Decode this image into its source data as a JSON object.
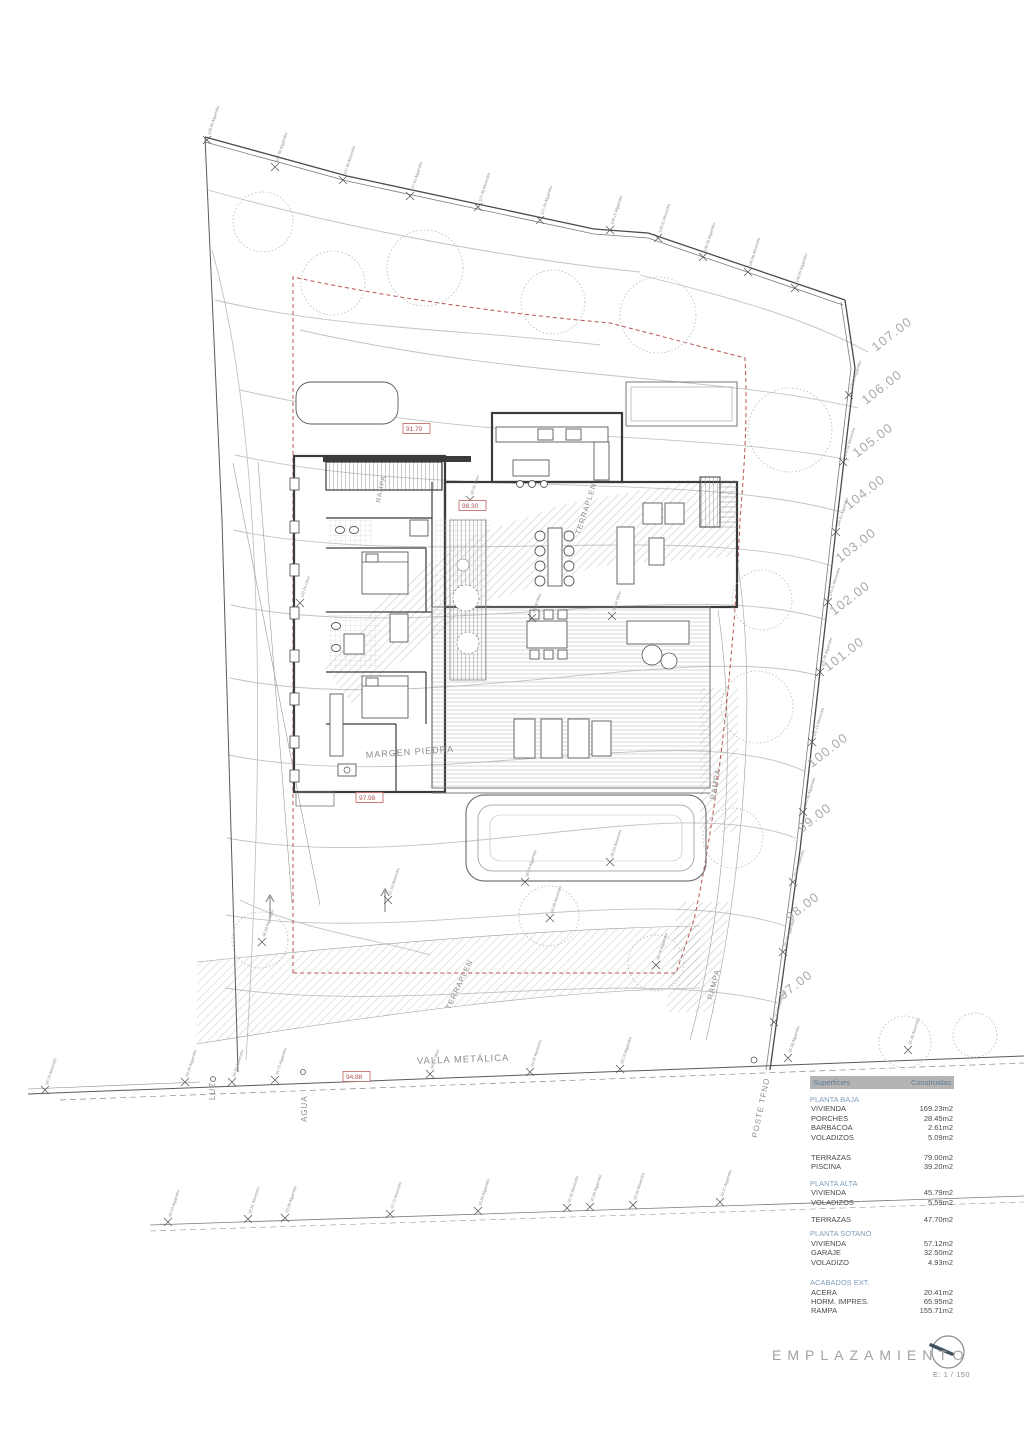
{
  "meta": {
    "sheet_title": "EMPLAZAMIENTO",
    "scale_label": "E: 1 / 150"
  },
  "table": {
    "header": [
      "Superficies",
      "Construidas"
    ],
    "groups": [
      {
        "title": "PLANTA BAJA",
        "gap": 6,
        "rows": [
          [
            "VIVIENDA",
            "169.23m2"
          ],
          [
            "PORCHES",
            "28.45m2"
          ],
          [
            "BARBACOA",
            "2.61m2"
          ],
          [
            "VOLADIZOS",
            "5.09m2"
          ]
        ]
      },
      {
        "title": "",
        "gap": 11,
        "rows": [
          [
            "TERRAZAS",
            "79.00m2"
          ],
          [
            "PISCINA",
            "39.20m2"
          ]
        ]
      },
      {
        "title": "PLANTA ALTA",
        "gap": 7,
        "rows": [
          [
            "VIVIENDA",
            "45.79m2"
          ],
          [
            "VOLADIZOS",
            "5.59m2"
          ]
        ]
      },
      {
        "title": "",
        "gap": 8,
        "rows": [
          [
            "TERRAZAS",
            "47.70m2"
          ]
        ]
      },
      {
        "title": "PLANTA SOTANO",
        "gap": 5,
        "rows": [
          [
            "VIVIENDA",
            "57.12m2"
          ],
          [
            "GARAJE",
            "32.50m2"
          ],
          [
            "VOLADIZO",
            "4.93m2"
          ]
        ]
      },
      {
        "title": "ACABADOS EXT.",
        "gap": 11,
        "rows": [
          [
            "ACERA",
            "20.41m2"
          ],
          [
            "HORM. IMPRES.",
            "65.95m2"
          ],
          [
            "RAMPA",
            "155.71m2"
          ]
        ]
      }
    ]
  },
  "contour_labels": [
    [
      876,
      352,
      "107.00"
    ],
    [
      866,
      405,
      "106.00"
    ],
    [
      857,
      458,
      "105.00"
    ],
    [
      849,
      510,
      "104.00"
    ],
    [
      840,
      563,
      "103.00"
    ],
    [
      834,
      616,
      "102.00"
    ],
    [
      828,
      672,
      "101.00"
    ],
    [
      812,
      768,
      "100.00"
    ],
    [
      802,
      833,
      "99.00"
    ],
    [
      790,
      922,
      "98.00"
    ],
    [
      783,
      1000,
      "97.00"
    ]
  ],
  "red_levels": [
    [
      406,
      431,
      "91.70"
    ],
    [
      462,
      508,
      "98.30"
    ],
    [
      359,
      800,
      "97.98"
    ],
    [
      346,
      1079,
      "94.88"
    ]
  ],
  "annotations": [
    [
      417,
      1064,
      -2,
      9.5,
      "VALLA METÁLICA"
    ],
    [
      215,
      1100,
      -90,
      8,
      "LUZ"
    ],
    [
      307,
      1122,
      -90,
      8,
      "AGUA"
    ],
    [
      757,
      1138,
      -78,
      8,
      "POSTE TFNO"
    ],
    [
      366,
      758,
      -4,
      9,
      "MARGEN PIEDRA"
    ],
    [
      580,
      535,
      -72,
      7.5,
      "TERRAPLEN"
    ],
    [
      450,
      1010,
      -65,
      7.5,
      "TERRAPLEN"
    ],
    [
      715,
      800,
      -80,
      7.5,
      "RAMPA"
    ],
    [
      712,
      1000,
      -75,
      7.5,
      "RAMPA"
    ],
    [
      380,
      503,
      -78,
      6.5,
      "RAMPA"
    ]
  ],
  "trees": [
    [
      207,
      140,
      "108.69 Algarrobo"
    ],
    [
      275,
      167,
      "107.69 Algarrobo"
    ],
    [
      343,
      180,
      "107.65 Almendro"
    ],
    [
      410,
      196,
      "107.53 Algarrobo"
    ],
    [
      478,
      207,
      "107.48 Almendro"
    ],
    [
      540,
      220,
      "107.40 Algarrobo"
    ],
    [
      610,
      230,
      "108.10 Algarrobo"
    ],
    [
      658,
      238,
      "108.31 Almendro"
    ],
    [
      703,
      257,
      "106.30 Algarrobo"
    ],
    [
      748,
      272,
      "106.66 Almendro"
    ],
    [
      795,
      288,
      "106.05 Algarrobo"
    ],
    [
      849,
      395,
      "106.92 Algarrobo"
    ],
    [
      843,
      462,
      "105.52 Almendro"
    ],
    [
      836,
      532,
      "104.61 Algarrobo"
    ],
    [
      828,
      602,
      "103.41 Almendro"
    ],
    [
      820,
      672,
      "102.46 Algarrobo"
    ],
    [
      812,
      742,
      "101.19 Almendro"
    ],
    [
      803,
      812,
      "100.08 Algarrobo"
    ],
    [
      793,
      882,
      "99.03 Almendro"
    ],
    [
      783,
      952,
      "98.12 Algarrobo"
    ],
    [
      774,
      1022,
      "97.36 Almendro"
    ],
    [
      300,
      603,
      "102.20 Olivo"
    ],
    [
      262,
      942,
      "96.58 Algarrobo"
    ],
    [
      388,
      900,
      "97.53 Almendro"
    ],
    [
      525,
      882,
      "96.53 Algarrobo"
    ],
    [
      610,
      862,
      "96.53 Almendro"
    ],
    [
      656,
      965,
      "95.79 Algarrobo"
    ],
    [
      550,
      918,
      "96.08 Almendro"
    ],
    [
      532,
      618,
      "98.08 Olivo"
    ],
    [
      612,
      616,
      "98.04 Olivo"
    ],
    [
      470,
      500,
      "99.02 Olivo"
    ],
    [
      45,
      1090,
      "94.20 Almendro"
    ],
    [
      185,
      1082,
      "94.49 Algarrobo"
    ],
    [
      232,
      1082,
      "94.60 Almendro"
    ],
    [
      275,
      1080,
      "94.70 Algarrobo"
    ],
    [
      430,
      1074,
      "94.70 Olivo"
    ],
    [
      530,
      1072,
      "94.92 Almendro"
    ],
    [
      620,
      1069,
      "95.10 Algarrobo"
    ],
    [
      788,
      1058,
      "95.58 Algarrobo"
    ],
    [
      908,
      1050,
      "95.96 Almendro"
    ],
    [
      168,
      1222,
      "92.54 Algarrobo"
    ],
    [
      248,
      1219,
      "92.61 Almendro"
    ],
    [
      285,
      1218,
      "92.68 Algarrobo"
    ],
    [
      390,
      1214,
      "92.72 Almendro"
    ],
    [
      478,
      1211,
      "92.84 Algarrobo"
    ],
    [
      567,
      1208,
      "92.92 Almendro"
    ],
    [
      590,
      1207,
      "92.95 Algarrobo"
    ],
    [
      633,
      1205,
      "93.02 Almendro"
    ],
    [
      720,
      1202,
      "93.27 Algarrobo"
    ]
  ],
  "canopies": [
    [
      263,
      222,
      30
    ],
    [
      333,
      283,
      32
    ],
    [
      425,
      268,
      38
    ],
    [
      553,
      302,
      32
    ],
    [
      658,
      315,
      38
    ],
    [
      790,
      430,
      42
    ],
    [
      762,
      600,
      30
    ],
    [
      757,
      707,
      36
    ],
    [
      733,
      838,
      30
    ],
    [
      656,
      963,
      28
    ],
    [
      549,
      916,
      30
    ],
    [
      260,
      940,
      28
    ],
    [
      905,
      1042,
      26
    ],
    [
      975,
      1035,
      22
    ]
  ],
  "colors": {
    "line": "#3b3b3b",
    "light": "#b8b8b8",
    "red": "#b24e4e",
    "accent_blue": "#83a0bd",
    "header_bar": "#b4b4b4"
  }
}
